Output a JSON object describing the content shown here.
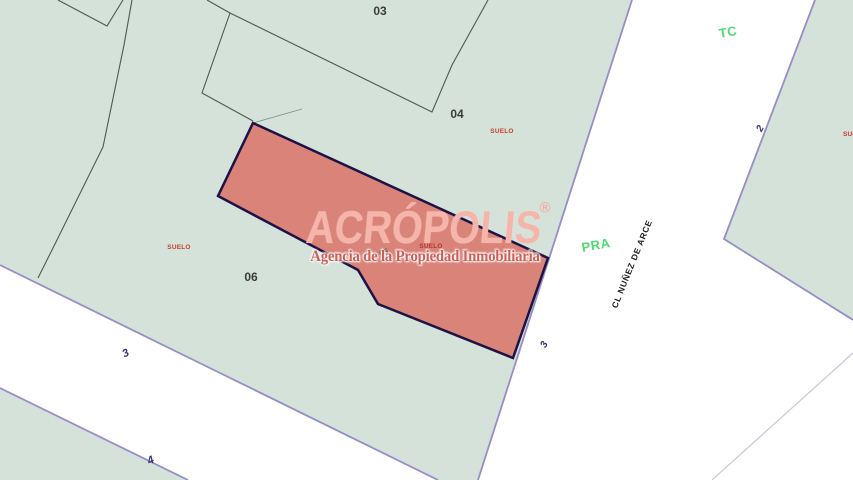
{
  "map": {
    "parcel_labels": {
      "p03": "03",
      "p04": "04",
      "p05": "05",
      "p06": "06"
    },
    "suelo_labels": {
      "top": "SUELO",
      "left": "SUELO",
      "center": "SUELO",
      "right": "SUELO"
    },
    "zone_labels": {
      "tc": "TC",
      "pra": "PRA"
    },
    "street_numbers": {
      "n2": "2",
      "n3_right": "3",
      "n3_left": "3",
      "n4": "4"
    },
    "street_name": "CL  NUÑEZ DE ARCE",
    "watermark": {
      "title": "ACRÓPOLIS",
      "registered": "®",
      "subtitle": "Agencia de la Propiedad Inmobiliaria"
    },
    "colors": {
      "parcel_fill_green": "#d4e2da",
      "highlight_parcel_fill": "#d98379",
      "highlight_parcel_border": "#1d1145",
      "street_edge_purple": "#988dc6",
      "building_line": "#4b5a50",
      "suelo_red": "#cd3b30",
      "zone_green": "#4edc72",
      "street_number_navy": "#2e3273",
      "watermark_pink": "#f5b5aa",
      "watermark_subtitle_red": "#cf5d55",
      "street_white": "#ffffff"
    }
  }
}
